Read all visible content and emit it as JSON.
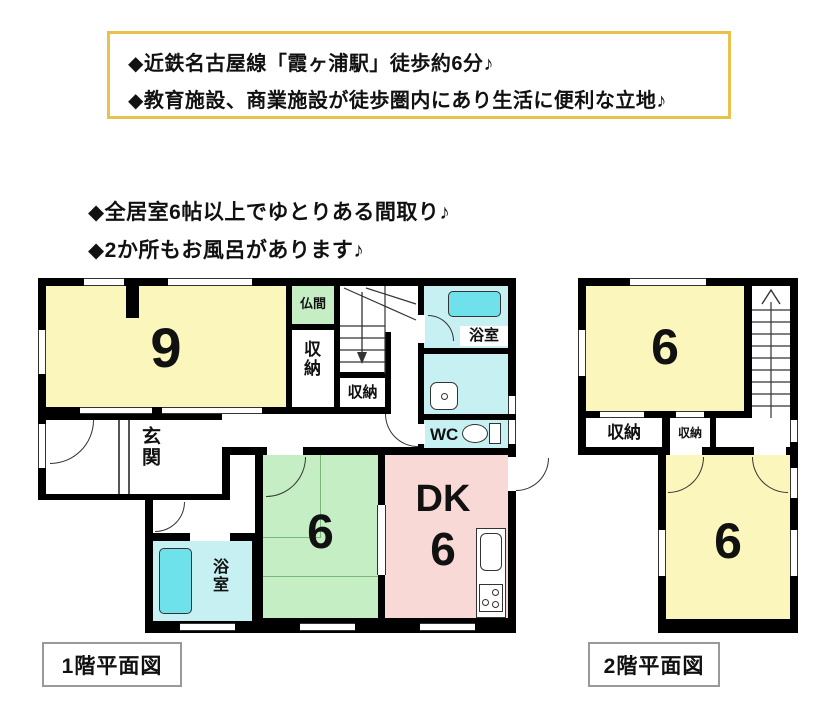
{
  "header_box": {
    "line1": "◆近鉄名古屋線「霞ヶ浦駅」徒歩約6分♪",
    "line2": "◆教育施設、商業施設が徒歩圏内にあり生活に便利な立地♪",
    "border_color": "#E8C24A"
  },
  "features": {
    "line1": "◆全居室6帖以上でゆとりある間取り♪",
    "line2": "◆2か所もお風呂があります♪"
  },
  "floor1": {
    "caption": "1階平面図",
    "rooms": {
      "living": "9",
      "butsuma": "仏間",
      "closet_vertical": "収納",
      "closet_under_stairs": "収納",
      "bath_upper": "浴室",
      "wc": "WC",
      "entrance": "玄関",
      "tatami": "6",
      "dk": "DK",
      "dk_size": "6",
      "bath_lower": "浴室"
    }
  },
  "floor2": {
    "caption": "2階平面図",
    "rooms": {
      "room_top": "6",
      "closet_large": "収納",
      "closet_small": "収納",
      "room_bottom": "6"
    }
  },
  "colors": {
    "room_yellow": "#FAF6BC",
    "room_green": "#C5EEC5",
    "room_pink": "#F9D9D5",
    "room_cyan": "#C7F0F2",
    "bathtub_cyan": "#6EE1EB",
    "wall_black": "#000000",
    "accent_border": "#E8C24A"
  }
}
